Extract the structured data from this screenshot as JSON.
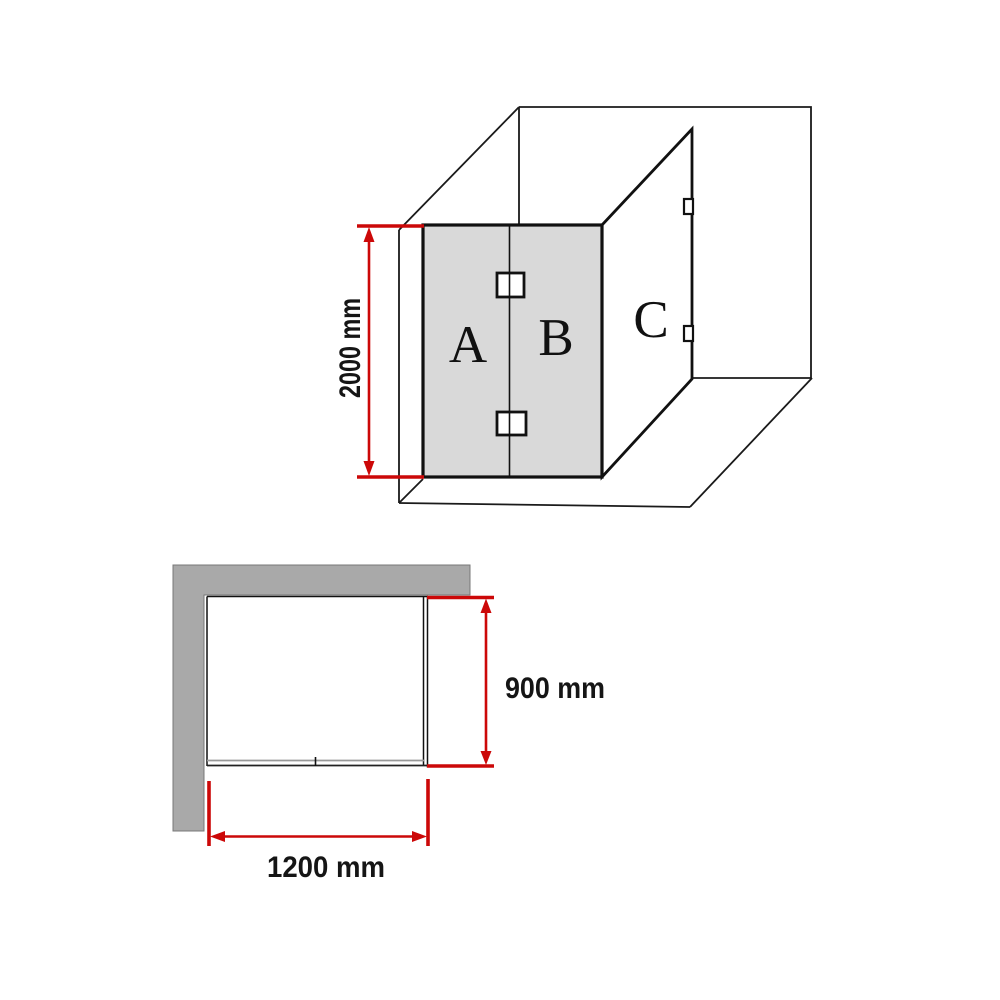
{
  "isometric_view": {
    "height_label": "2000 mm",
    "panels": {
      "a": "A",
      "b": "B",
      "c": "C"
    }
  },
  "plan_view": {
    "depth_label": "900 mm",
    "width_label": "1200 mm"
  },
  "colors": {
    "dimension_red": "#cc0808",
    "glass_gray": "#d9d9d9",
    "wall_gray": "#a9a9a9",
    "line_black": "#111111"
  }
}
